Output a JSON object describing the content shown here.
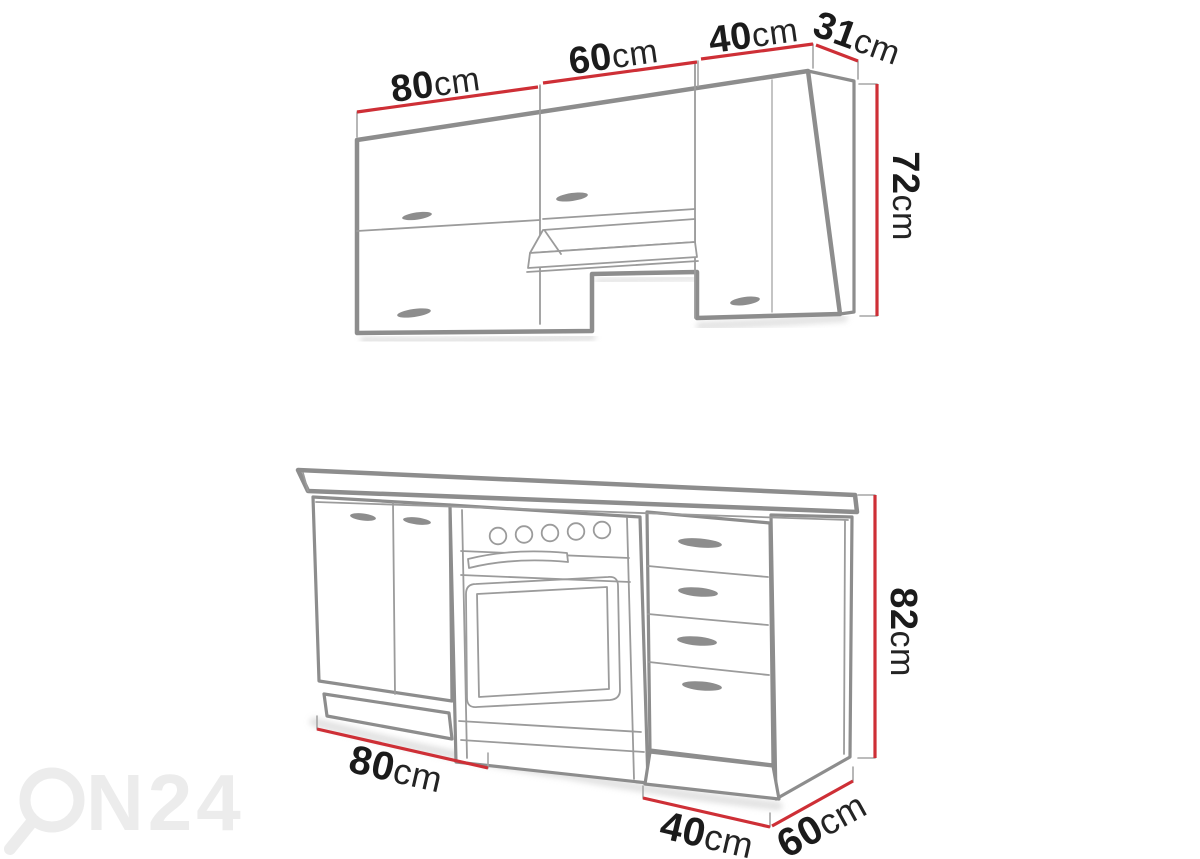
{
  "page": {
    "width": 1200,
    "height": 859,
    "background": "#ffffff",
    "description": "Kitchen cabinet set — line drawing with dimension callouts"
  },
  "colors": {
    "outline_gray": "#8d8d8d",
    "detail_gray": "#9b9b9b",
    "dimension_red": "#ce2f36",
    "label_black": "#1b1b1b",
    "watermark_gray": "#ececec"
  },
  "upper_row": {
    "name": "wall cabinets",
    "dims": {
      "w80": {
        "value": "80",
        "unit": "cm"
      },
      "w60": {
        "value": "60",
        "unit": "cm"
      },
      "w40": {
        "value": "40",
        "unit": "cm"
      },
      "depth": {
        "value": "31",
        "unit": "cm"
      },
      "height": {
        "value": "72",
        "unit": "cm"
      }
    }
  },
  "lower_row": {
    "name": "base cabinets with oven and drawer unit",
    "dims": {
      "w80": {
        "value": "80",
        "unit": "cm"
      },
      "w40": {
        "value": "40",
        "unit": "cm"
      },
      "depth": {
        "value": "60",
        "unit": "cm"
      },
      "height": {
        "value": "82",
        "unit": "cm"
      }
    }
  },
  "watermark": {
    "brand": "ON24",
    "letters_after_symbol": "N24"
  }
}
